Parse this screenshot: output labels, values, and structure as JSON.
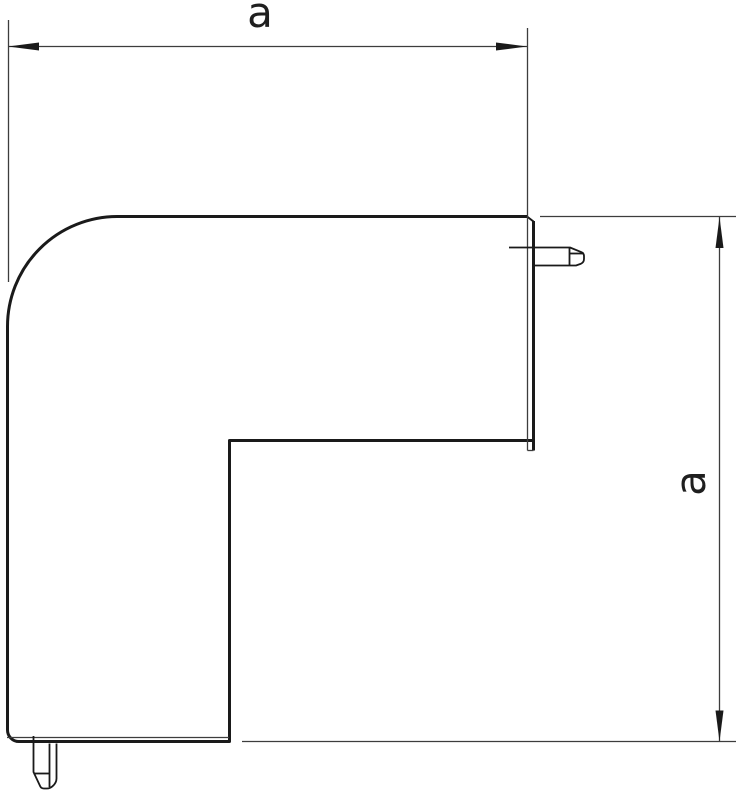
{
  "drawing": {
    "labels": {
      "width": "a",
      "height": "a"
    },
    "colors": {
      "outline": "#1a1a1a",
      "thin_line": "#3d3d3d",
      "background": "#ffffff"
    }
  }
}
